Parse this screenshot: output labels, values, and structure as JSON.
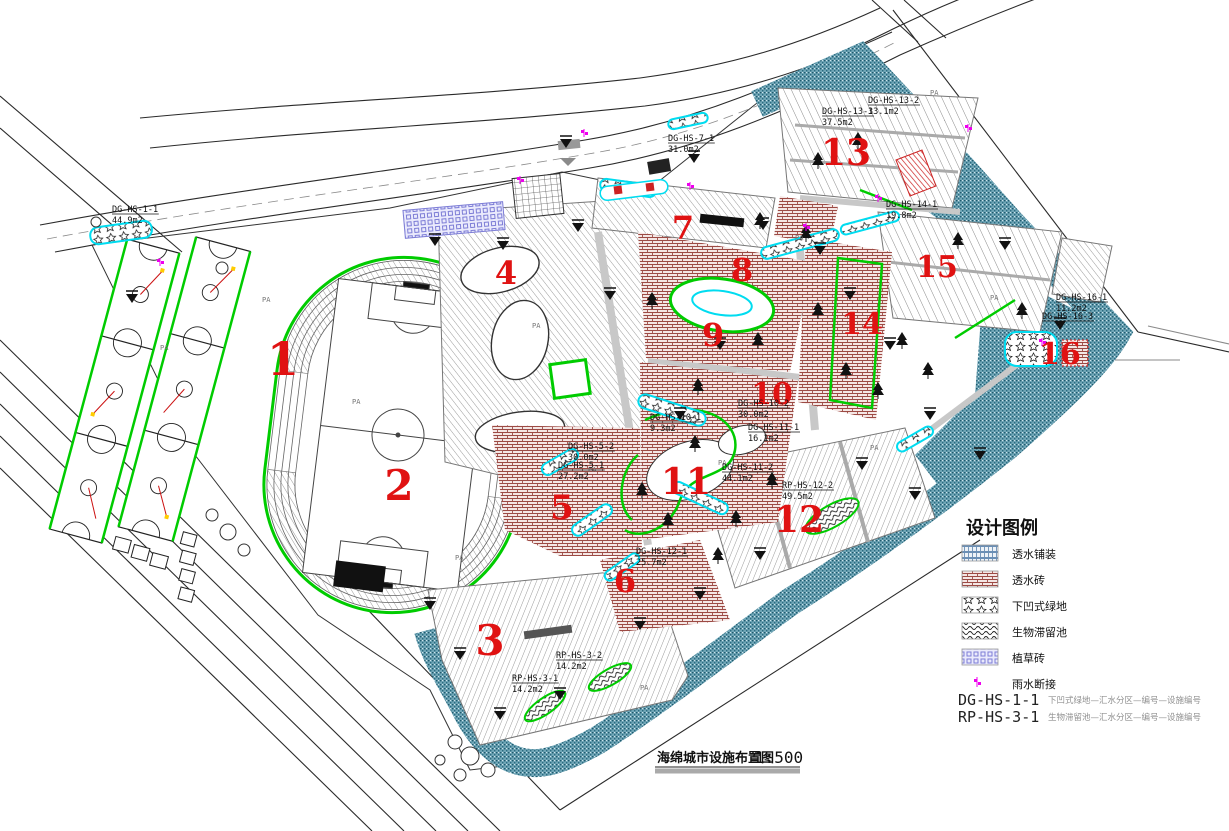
{
  "drawing": {
    "title_text": "海绵城市设施布置图",
    "scale_text": "1:500"
  },
  "legend": {
    "title": "设计图例",
    "items": [
      {
        "label": "透水铺装",
        "swatch": "legend-permeable-paving"
      },
      {
        "label": "透水砖",
        "swatch": "legend-permeable-brick"
      },
      {
        "label": "下凹式绿地",
        "swatch": "legend-sunken-green"
      },
      {
        "label": "生物滞留池",
        "swatch": "legend-bioretention"
      },
      {
        "label": "植草砖",
        "swatch": "legend-grass-paver"
      },
      {
        "label": "雨水断接",
        "swatch": "legend-rain-disconnect"
      }
    ],
    "codes": [
      {
        "code": "DG-HS-1-1",
        "desc": "下凹式绿地—汇水分区—编号—设施编号"
      },
      {
        "code": "RP-HS-3-1",
        "desc": "生物滞留池—汇水分区—编号—设施编号"
      }
    ]
  },
  "colors": {
    "zone_number_red": "#e01212",
    "green_outline": "#00cc00",
    "cyan_water": "#00dcf0",
    "teal_buffer": "#4f93a8",
    "brick_red": "#9c4a44",
    "hatch_gray": "#999999",
    "grass_paver_purple": "#7d7dd6",
    "magenta_marker": "#ee00ee"
  },
  "zone_numbers": [
    {
      "n": "1",
      "x": 283,
      "y": 375,
      "s": 46
    },
    {
      "n": "2",
      "x": 399,
      "y": 500,
      "s": 42
    },
    {
      "n": "3",
      "x": 490,
      "y": 655,
      "s": 42
    },
    {
      "n": "4",
      "x": 506,
      "y": 284,
      "s": 32
    },
    {
      "n": "5",
      "x": 562,
      "y": 519,
      "s": 34
    },
    {
      "n": "6",
      "x": 625,
      "y": 592,
      "s": 32
    },
    {
      "n": "7",
      "x": 683,
      "y": 239,
      "s": 32
    },
    {
      "n": "8",
      "x": 742,
      "y": 281,
      "s": 32
    },
    {
      "n": "9",
      "x": 713,
      "y": 346,
      "s": 32
    },
    {
      "n": "10",
      "x": 772,
      "y": 404,
      "s": 30
    },
    {
      "n": "11",
      "x": 686,
      "y": 494,
      "s": 36
    },
    {
      "n": "12",
      "x": 799,
      "y": 532,
      "s": 36
    },
    {
      "n": "13",
      "x": 846,
      "y": 165,
      "s": 36
    },
    {
      "n": "14",
      "x": 862,
      "y": 334,
      "s": 30
    },
    {
      "n": "15",
      "x": 937,
      "y": 277,
      "s": 30
    },
    {
      "n": "16",
      "x": 1060,
      "y": 364,
      "s": 30
    }
  ],
  "facility_labels": [
    [
      "DG-HS-1-1",
      "44.9m2",
      112,
      212
    ],
    [
      "DG-HS-7-1",
      "31.0m2",
      668,
      141
    ],
    [
      "DG-HS-13-1",
      "37.5m2",
      822,
      114
    ],
    [
      "DG-HS-13-2",
      "33.1m2",
      868,
      103
    ],
    [
      "DG-HS-14-1",
      "19.8m2",
      886,
      207
    ],
    [
      "DG-HS-16-1",
      "11.2m2",
      1056,
      300
    ],
    [
      "DG-HS-16-3",
      "",
      1042,
      319
    ],
    [
      "DG-HS-10-2",
      "30.0m2",
      738,
      406
    ],
    [
      "DG-HS-10-1",
      "9.3m2",
      650,
      420
    ],
    [
      "DG-HS-11-1",
      "16.1m2",
      748,
      430
    ],
    [
      "DG-HS-11-2",
      "44.1m2",
      722,
      470
    ],
    [
      "RP-HS-12-2",
      "49.5m2",
      782,
      488
    ],
    [
      "DG-HS-12-1",
      "25.7m2",
      636,
      554
    ],
    [
      "DG-HS-5-2",
      "30.0m2",
      568,
      449
    ],
    [
      "DG-HS-5-1",
      "27.2m2",
      558,
      468
    ],
    [
      "RP-HS-3-2",
      "14.2m2",
      556,
      658
    ],
    [
      "RP-HS-3-1",
      "14.2m2",
      512,
      681
    ]
  ],
  "pa_label": "PA",
  "pa_markers": [
    [
      352,
      404
    ],
    [
      532,
      328
    ],
    [
      588,
      472
    ],
    [
      640,
      690
    ],
    [
      718,
      465
    ],
    [
      795,
      240
    ],
    [
      930,
      95
    ],
    [
      990,
      300
    ],
    [
      870,
      450
    ],
    [
      262,
      302
    ],
    [
      160,
      350
    ],
    [
      455,
      560
    ]
  ],
  "flow_arrows": [
    [
      132,
      303
    ],
    [
      435,
      246
    ],
    [
      503,
      250
    ],
    [
      578,
      232
    ],
    [
      610,
      300
    ],
    [
      566,
      148
    ],
    [
      694,
      163
    ],
    [
      763,
      230
    ],
    [
      820,
      255
    ],
    [
      850,
      300
    ],
    [
      890,
      350
    ],
    [
      930,
      420
    ],
    [
      862,
      470
    ],
    [
      915,
      500
    ],
    [
      700,
      600
    ],
    [
      640,
      630
    ],
    [
      560,
      700
    ],
    [
      500,
      720
    ],
    [
      460,
      660
    ],
    [
      430,
      610
    ],
    [
      1005,
      250
    ],
    [
      1060,
      330
    ],
    [
      980,
      460
    ],
    [
      760,
      560
    ],
    [
      680,
      420
    ],
    [
      720,
      350
    ]
  ],
  "tree_markers": [
    [
      652,
      292
    ],
    [
      698,
      378
    ],
    [
      758,
      332
    ],
    [
      818,
      302
    ],
    [
      846,
      362
    ],
    [
      878,
      382
    ],
    [
      642,
      482
    ],
    [
      718,
      547
    ],
    [
      772,
      472
    ],
    [
      902,
      332
    ],
    [
      928,
      362
    ],
    [
      818,
      152
    ],
    [
      858,
      132
    ],
    [
      958,
      232
    ],
    [
      1022,
      302
    ],
    [
      760,
      212
    ],
    [
      806,
      225
    ],
    [
      695,
      435
    ],
    [
      668,
      512
    ],
    [
      736,
      510
    ]
  ],
  "magenta_markers": [
    [
      160,
      262
    ],
    [
      584,
      133
    ],
    [
      806,
      227
    ],
    [
      878,
      198
    ],
    [
      968,
      128
    ],
    [
      1042,
      342
    ],
    [
      690,
      186
    ],
    [
      520,
      180
    ]
  ]
}
